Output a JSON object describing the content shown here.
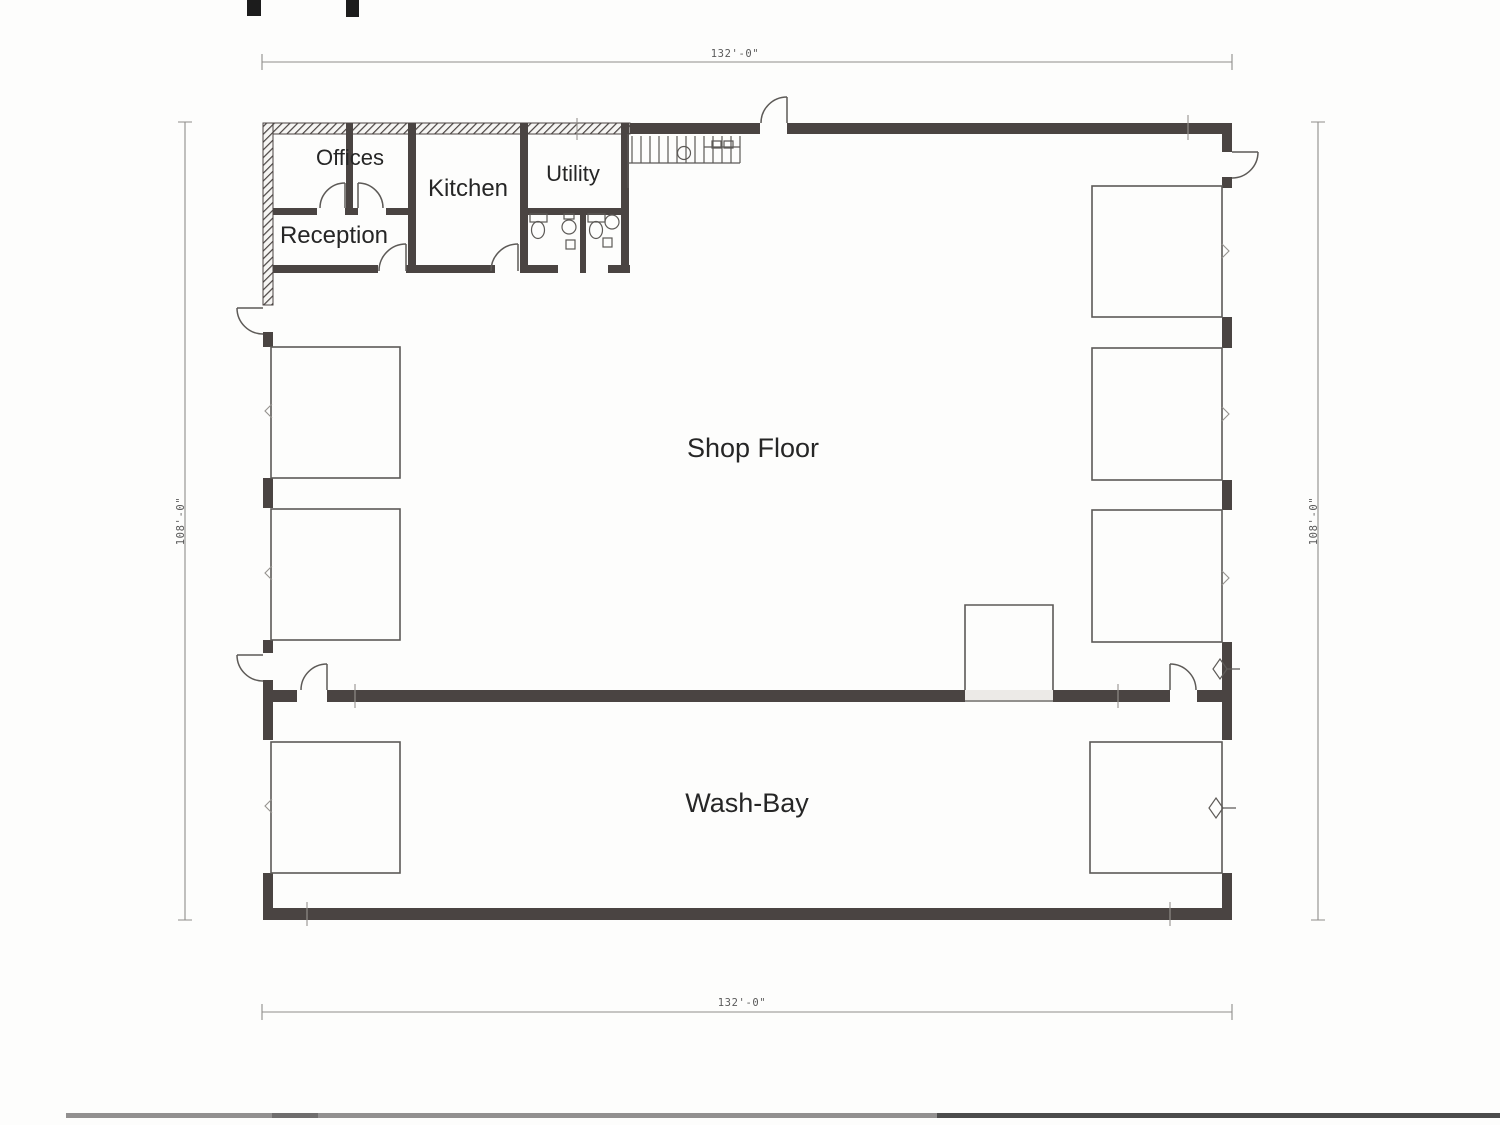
{
  "rooms": {
    "offices": "Offices",
    "reception": "Reception",
    "kitchen": "Kitchen",
    "utility": "Utility",
    "shop_floor": "Shop Floor",
    "wash_bay": "Wash-Bay"
  },
  "dimensions": {
    "top": "132'-0\"",
    "bottom": "132'-0\"",
    "left": "108'-0\"",
    "right": "108'-0\""
  },
  "colors": {
    "paper": "#fdfdfc",
    "wall": "#4a4442",
    "thin_line": "#5d5a57",
    "dim_line": "#8f8d8a",
    "dimension_text": "#5a5a5a",
    "label_text": "#262626",
    "scan_bar_left": "#929090",
    "scan_bar_right": "#4c4c4c"
  }
}
